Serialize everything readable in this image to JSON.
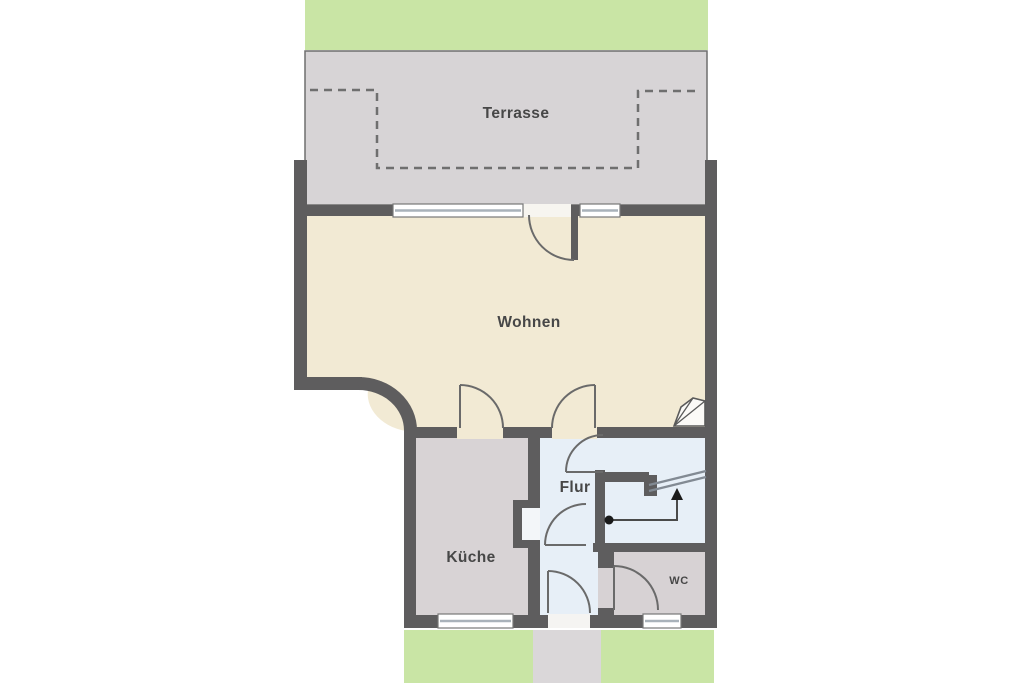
{
  "plan": {
    "type": "apartment-floor-plan",
    "labels": {
      "terrace": "Terrasse",
      "living": "Wohnen",
      "kitchen": "Küche",
      "hall": "Flur",
      "wc": "WC"
    },
    "colors": {
      "garden": "#c9e5a5",
      "terrace_floor": "#d7d4d6",
      "living_floor": "#f2ead4",
      "kitchen_floor": "#d8d3d5",
      "hall_floor": "#e7eff7",
      "wc_floor": "#d7d2d4",
      "niche": "#f3f6f9",
      "walkway": "#dad7d9",
      "wall": "#5e5d5e",
      "door_arc": "#6a6a6a",
      "window_line": "#a9b2ba",
      "stair_line": "#828a93",
      "dashed_line": "#6f6f6f",
      "label_text": "#474747"
    },
    "stairs": {
      "direction": "up",
      "symbol": "dot-line-arrow"
    }
  }
}
